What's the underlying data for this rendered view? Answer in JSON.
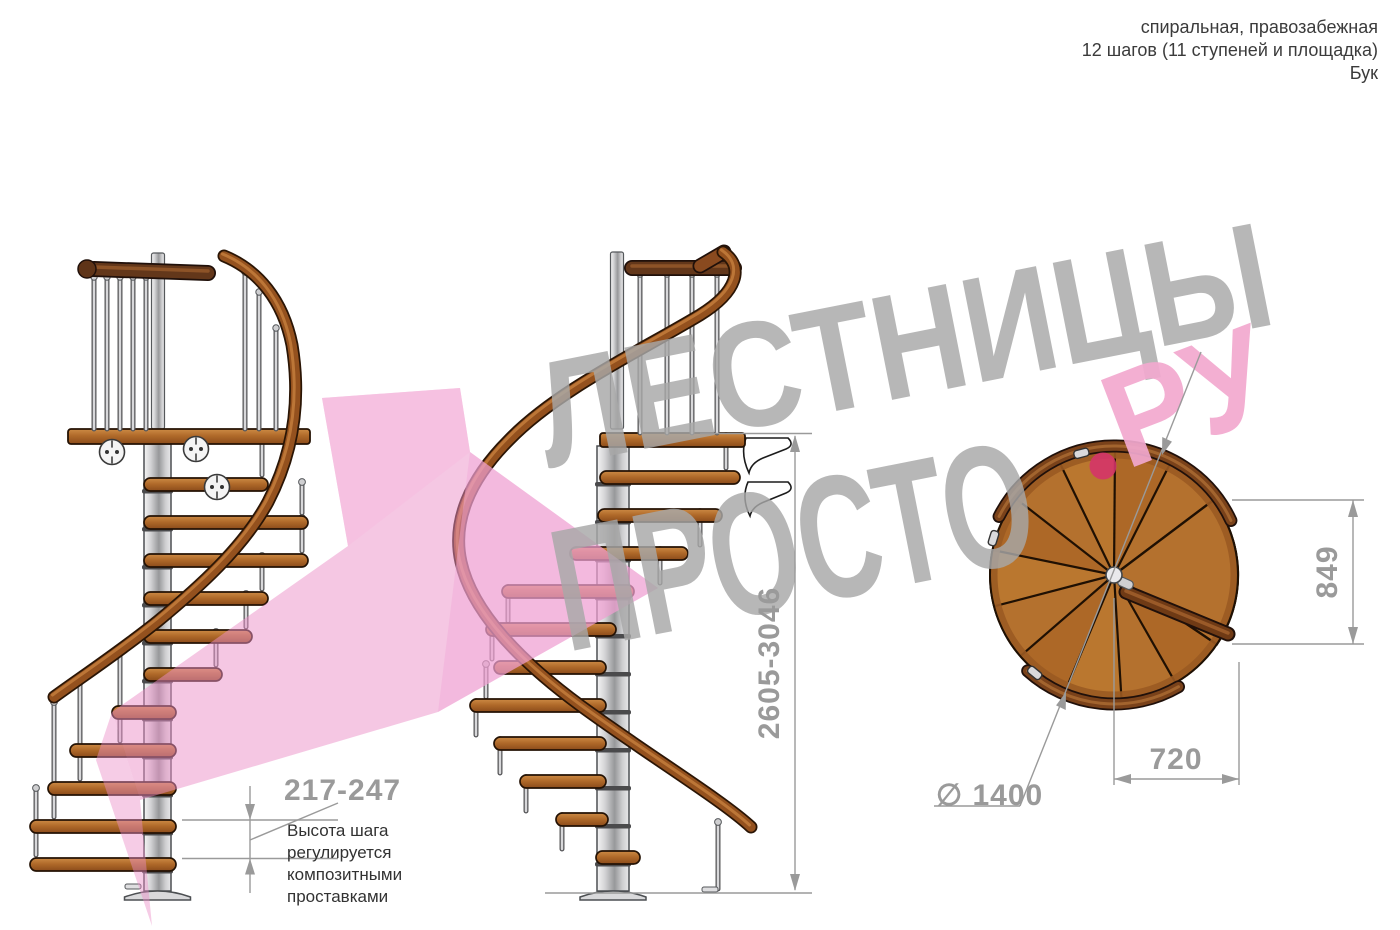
{
  "header": {
    "lines": [
      "спиральная, правозабежная",
      "12 шагов (11 ступеней и площадка)",
      "Бук"
    ]
  },
  "watermark": {
    "word1": "ЛЕСТНИЦЫ",
    "word2": "ПРОСТО",
    "suffix": "РУ",
    "dot": ".",
    "gray_color": "#a8a8a8",
    "pink_text_color": "#f2a9cf",
    "dot_color": "#d5336b",
    "arrow_pink_color": "#ec8fc8"
  },
  "dimensions": {
    "step_height": {
      "value": "217-247",
      "note": [
        "Высота шага",
        "регулируется",
        "композитными",
        "проставками"
      ]
    },
    "total_height": {
      "value": "2605-3046"
    },
    "plan_depth": {
      "value": "849"
    },
    "plan_width": {
      "value": "720"
    },
    "diameter": {
      "value": "∅ 1400"
    }
  },
  "palette": {
    "wood": "#b4712e",
    "wood_dark": "#8a4d1d",
    "handrail": "#94511e",
    "dark_rail": "#63371a",
    "metal": "#c9c9cb",
    "dim_gray": "#9a9a9a",
    "outline": "#241204"
  },
  "views": {
    "left": {
      "pole": {
        "cx": 157.5,
        "w": 27,
        "topY": 444,
        "bottomY": 891
      },
      "post": {
        "x": 158,
        "w": 13,
        "y1": 253,
        "y2": 429
      },
      "landing": {
        "x1": 68,
        "x2": 310,
        "y": 429,
        "h": 15
      },
      "toprail": {
        "x1": 94,
        "y1": 269,
        "x2": 208,
        "y2": 273,
        "ball": [
          87,
          269
        ]
      },
      "rail": "M224,256 C258,270 283,300 292,345 C301,400 294,452 268,502 C243,548 198,588 158,621 C118,653 80,678 54,697",
      "balusters": [
        [
          94,
          277,
          429
        ],
        [
          107,
          277,
          429
        ],
        [
          120,
          277,
          429
        ],
        [
          133,
          277,
          429
        ],
        [
          146,
          277,
          429
        ],
        [
          245,
          272,
          429
        ],
        [
          259,
          292,
          429
        ],
        [
          276,
          328,
          429
        ]
      ],
      "discs": [
        [
          112,
          452
        ],
        [
          196,
          449
        ],
        [
          217,
          487
        ]
      ],
      "steps": [
        [
          478,
          144,
          268
        ],
        [
          516,
          144,
          308
        ],
        [
          554,
          144,
          308
        ],
        [
          592,
          144,
          268
        ],
        [
          630,
          144,
          252
        ],
        [
          668,
          144,
          222
        ],
        [
          706,
          112,
          176
        ],
        [
          744,
          70,
          176
        ],
        [
          782,
          48,
          176
        ],
        [
          820,
          30,
          176
        ],
        [
          858,
          30,
          176
        ]
      ],
      "rods": [
        [
          262,
          440,
          475
        ],
        [
          302,
          482,
          513
        ],
        [
          302,
          518,
          551
        ],
        [
          262,
          556,
          589
        ],
        [
          246,
          594,
          627
        ],
        [
          216,
          632,
          665
        ],
        [
          120,
          650,
          741
        ],
        [
          80,
          682,
          779
        ],
        [
          54,
          702,
          817
        ],
        [
          36,
          788,
          855
        ]
      ],
      "feet": [
        [
          133,
          884
        ]
      ]
    },
    "middle": {
      "pole": {
        "cx": 613,
        "w": 32,
        "topY": 446,
        "bottomY": 891
      },
      "post": {
        "x": 617,
        "w": 13,
        "y1": 252,
        "y2": 429
      },
      "landing": {
        "x1": 600,
        "x2": 745,
        "y": 433,
        "h": 14
      },
      "toprail": {
        "x1": 632,
        "y1": 268,
        "x2": 734,
        "y2": 268,
        "diag": [
          700,
          266,
          724,
          252
        ]
      },
      "rail": "M723,252 C745,267 737,292 700,315 C640,351 556,391 509,440 C469,480 452,522 461,562 C472,612 521,662 581,706 C648,755 722,800 751,827",
      "balusters": [
        [
          640,
          274,
          433
        ],
        [
          667,
          274,
          433
        ],
        [
          692,
          274,
          433
        ],
        [
          717,
          274,
          433
        ]
      ],
      "discs": [],
      "steps": [
        [
          471,
          600,
          740
        ],
        [
          509,
          598,
          722
        ],
        [
          547,
          570,
          688
        ],
        [
          585,
          502,
          634
        ],
        [
          623,
          486,
          616
        ],
        [
          661,
          494,
          606
        ],
        [
          699,
          470,
          606
        ],
        [
          737,
          494,
          606
        ],
        [
          775,
          520,
          606
        ],
        [
          813,
          556,
          608
        ],
        [
          851,
          596,
          640
        ]
      ],
      "rods": [
        [
          726,
          436,
          468
        ],
        [
          700,
          512,
          545
        ],
        [
          660,
          550,
          583
        ],
        [
          508,
          588,
          621
        ],
        [
          492,
          626,
          659
        ],
        [
          486,
          664,
          697
        ],
        [
          476,
          702,
          735
        ],
        [
          500,
          740,
          773
        ],
        [
          526,
          778,
          811
        ],
        [
          562,
          816,
          849
        ],
        [
          718,
          822,
          889
        ]
      ],
      "feet": [
        [
          710,
          887
        ]
      ],
      "brackets": [
        "M746,438 h42 q7,7 -2,11 l-23,9 q-12,5 -14,15 q-9,-19 -3,-35 z",
        "M748,482 h40 q7,7 -2,11 l-22,9 q-12,5 -14,14 q-9,-18 -2,-34 z"
      ]
    },
    "top": {
      "cx": 1114,
      "cy": 575,
      "r": 124,
      "landing_angles": [
        -34,
        37
      ],
      "n_steps": 11,
      "rail_arc_top": [
        25,
        153
      ],
      "rail_arc_bottom": [
        228,
        300
      ],
      "rail_r": 129,
      "rim_blocks": [
        105,
        163,
        231
      ],
      "landing_bar": [
        1126,
        592,
        1228,
        634
      ]
    }
  }
}
